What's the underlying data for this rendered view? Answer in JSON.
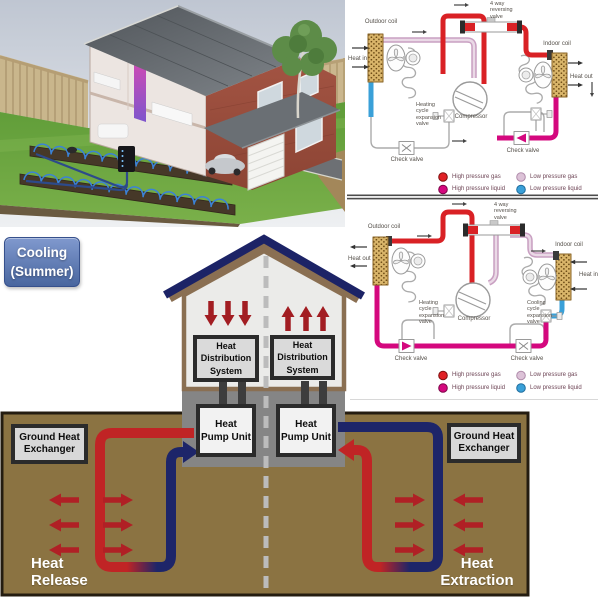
{
  "badge": {
    "label": "Cooling (Summer)"
  },
  "cross_section": {
    "distribution_left": "Heat Distribution System",
    "distribution_right": "Heat Distribution System",
    "pump_left": "Heat Pump Unit",
    "pump_right": "Heat Pump Unit",
    "exchanger_left": "Ground Heat Exchanger",
    "exchanger_right": "Ground Heat Exchanger",
    "release": "Heat Release",
    "extraction": "Heat Extraction"
  },
  "cycle_top": {
    "reversing_valve": "4 way reversing valve",
    "outdoor_coil": "Outdoor coil",
    "indoor_coil": "Indoor coil",
    "heat_in": "Heat in",
    "heat_out": "Heat out",
    "expansion_heating": "Heating cycle expansion valve",
    "compressor": "Compressor",
    "check_left": "Check valve",
    "check_right": "Check valve"
  },
  "cycle_bottom": {
    "reversing_valve": "4 way reversing valve",
    "outdoor_coil": "Outdoor coil",
    "indoor_coil": "Indoor coil",
    "heat_in": "Heat in",
    "heat_out": "Heat out",
    "expansion_heating": "Heating cycle expansion valve",
    "expansion_cooling": "Cooling cycle expansion valve",
    "compressor": "Compressor",
    "check_left": "Check valve",
    "check_right": "Check valve"
  },
  "legend": {
    "hp_gas": "High pressure gas",
    "hp_liquid": "High pressure liquid",
    "lp_gas": "Low pressure gas",
    "lp_liquid": "Low pressure liquid"
  },
  "colors": {
    "hp_gas": "#d92125",
    "hp_liquid": "#d4087e",
    "lp_gas": "#d9bcd3",
    "lp_liquid": "#3aa0d8",
    "pipe_red": "#c02425",
    "pipe_blue": "#1d2569",
    "ground_brown": "#8b7342",
    "badge_blue": "#5d7cba",
    "arrow_red": "#b02025"
  }
}
